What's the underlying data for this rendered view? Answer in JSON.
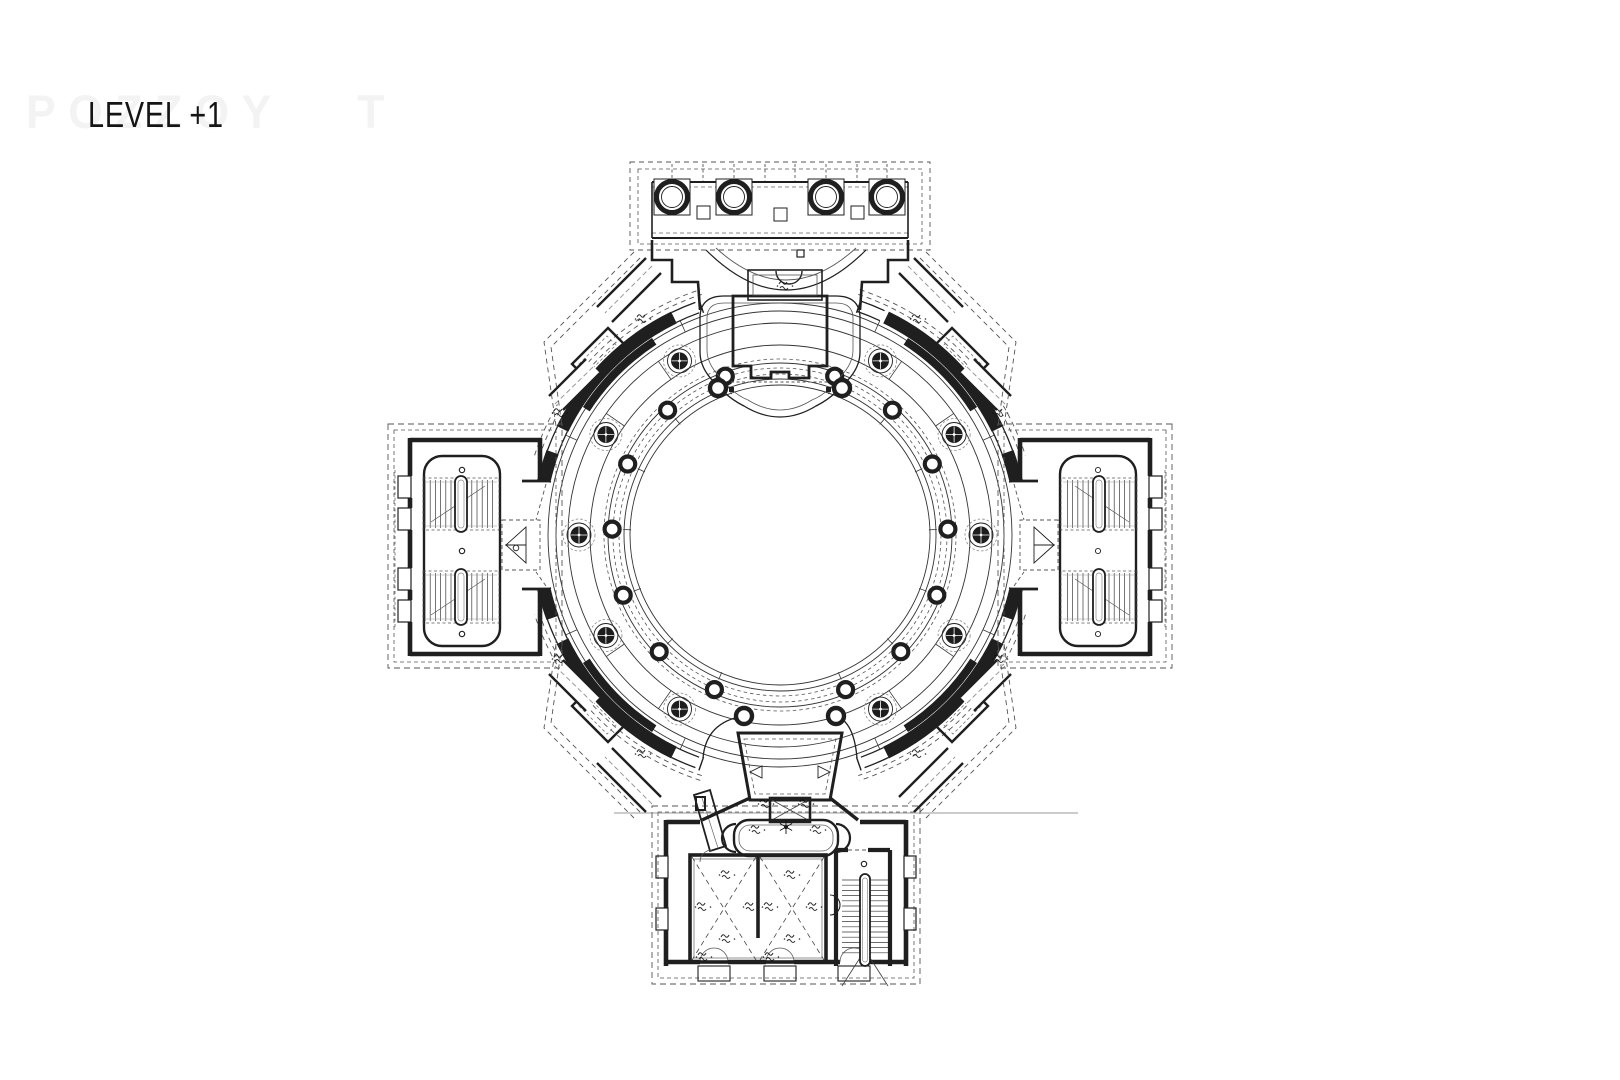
{
  "title": {
    "text": "LEVEL +1"
  },
  "watermark": {
    "text": "POZZOY   T"
  },
  "colors": {
    "ink": "#1f1f1f",
    "thin": "#3a3a3a",
    "gray": "#7d7d7d",
    "dash": "#555555",
    "bg": "#ffffff"
  },
  "plan": {
    "name": "circular-rotunda-floor-plan",
    "parts": [
      "north-portico",
      "rotunda",
      "west-stair-wing",
      "east-stair-wing",
      "south-wing",
      "north-vestibule",
      "south-vestibule"
    ],
    "geometry": {
      "center": [
        780,
        535
      ],
      "rings_solid": [
        150,
        156,
        172,
        190,
        212,
        224,
        232
      ],
      "rings_dashed": [
        161,
        167,
        176
      ],
      "drum": {
        "r": 242,
        "w": 13,
        "thick": [
          [
            26,
            64
          ],
          [
            70,
            77
          ],
          [
            103,
            110
          ],
          [
            116,
            154
          ],
          [
            206,
            244
          ],
          [
            250,
            257
          ],
          [
            283,
            290
          ],
          [
            296,
            334
          ]
        ],
        "pier_inner": {
          "r": 231,
          "w": 8,
          "arcs": [
            [
              33,
              57
            ],
            [
              123,
              147
            ],
            [
              213,
              237
            ],
            [
              303,
              327
            ]
          ]
        },
        "window_radii": [
          236.5,
          247.5
        ],
        "windows": [
          [
            19,
            25
          ],
          [
            64,
            70
          ],
          [
            110,
            116
          ],
          [
            154,
            160
          ],
          [
            200,
            206
          ],
          [
            244,
            250
          ],
          [
            290,
            296
          ],
          [
            334,
            340
          ]
        ],
        "dashed_outer": {
          "radii": [
            253,
            258
          ],
          "arcs": [
            [
              18,
              72
            ],
            [
              108,
              162
            ],
            [
              198,
              252
            ],
            [
              288,
              342
            ]
          ]
        },
        "caps": [
          19,
          77,
          103,
          161,
          199,
          257,
          283,
          341
        ]
      },
      "rosettes": {
        "r": 201,
        "angles": [
          30,
          60,
          90,
          120,
          150,
          210,
          240,
          270,
          300,
          330
        ]
      },
      "inner_columns": {
        "r": 168,
        "angles": [
          19,
          42,
          65,
          88,
          111,
          134,
          157,
          203,
          226,
          249,
          272,
          295,
          318,
          341
        ]
      },
      "ticks": {
        "outer": {
          "r1": 224,
          "r2": 236,
          "angles": [
            25,
            65,
            115,
            155,
            205,
            245,
            295,
            335
          ]
        },
        "mid": {
          "r1": 190,
          "r2": 212,
          "angles": [
            35,
            55,
            125,
            145,
            215,
            235,
            305,
            325
          ]
        },
        "inner": {
          "r1": 149,
          "r2": 157,
          "angles": [
            19,
            42,
            65,
            88,
            111,
            134,
            157,
            203,
            226,
            249,
            272,
            295,
            318,
            341
          ]
        }
      },
      "portico_columns": {
        "cy": 197,
        "xs": [
          672,
          734,
          826,
          887
        ],
        "ring_r": 15.5,
        "inner_r": 10.5,
        "pedestal": 36,
        "grid_xs": [
          672,
          703,
          734,
          765,
          795,
          826,
          857,
          887
        ],
        "blocks": [
          [
            703,
            206
          ],
          [
            780,
            208
          ],
          [
            857,
            206
          ]
        ]
      },
      "stairs_west": [
        [
          425,
          480,
          72,
          48
        ],
        [
          425,
          573,
          72,
          48
        ]
      ],
      "stair_south": [
        842,
        880,
        46,
        78
      ],
      "level_markers": [
        [
          785,
          285
        ],
        [
          643,
          318
        ],
        [
          918,
          318
        ],
        [
          560,
          412
        ],
        [
          1000,
          412
        ],
        [
          560,
          658
        ],
        [
          1000,
          658
        ],
        [
          643,
          753
        ],
        [
          918,
          753
        ],
        [
          766,
          803
        ],
        [
          806,
          803
        ],
        [
          757,
          829
        ],
        [
          818,
          829
        ],
        [
          727,
          874
        ],
        [
          727,
          938
        ],
        [
          703,
          906
        ],
        [
          751,
          906
        ],
        [
          792,
          874
        ],
        [
          792,
          938
        ],
        [
          770,
          906
        ],
        [
          814,
          906
        ],
        [
          704,
          956
        ],
        [
          771,
          956
        ]
      ],
      "snowflake": [
        786,
        827
      ],
      "c_marks": [
        [
          516,
          548
        ],
        [
          462,
          470
        ],
        [
          462,
          551
        ],
        [
          462,
          634
        ],
        [
          864,
          864
        ]
      ]
    }
  }
}
